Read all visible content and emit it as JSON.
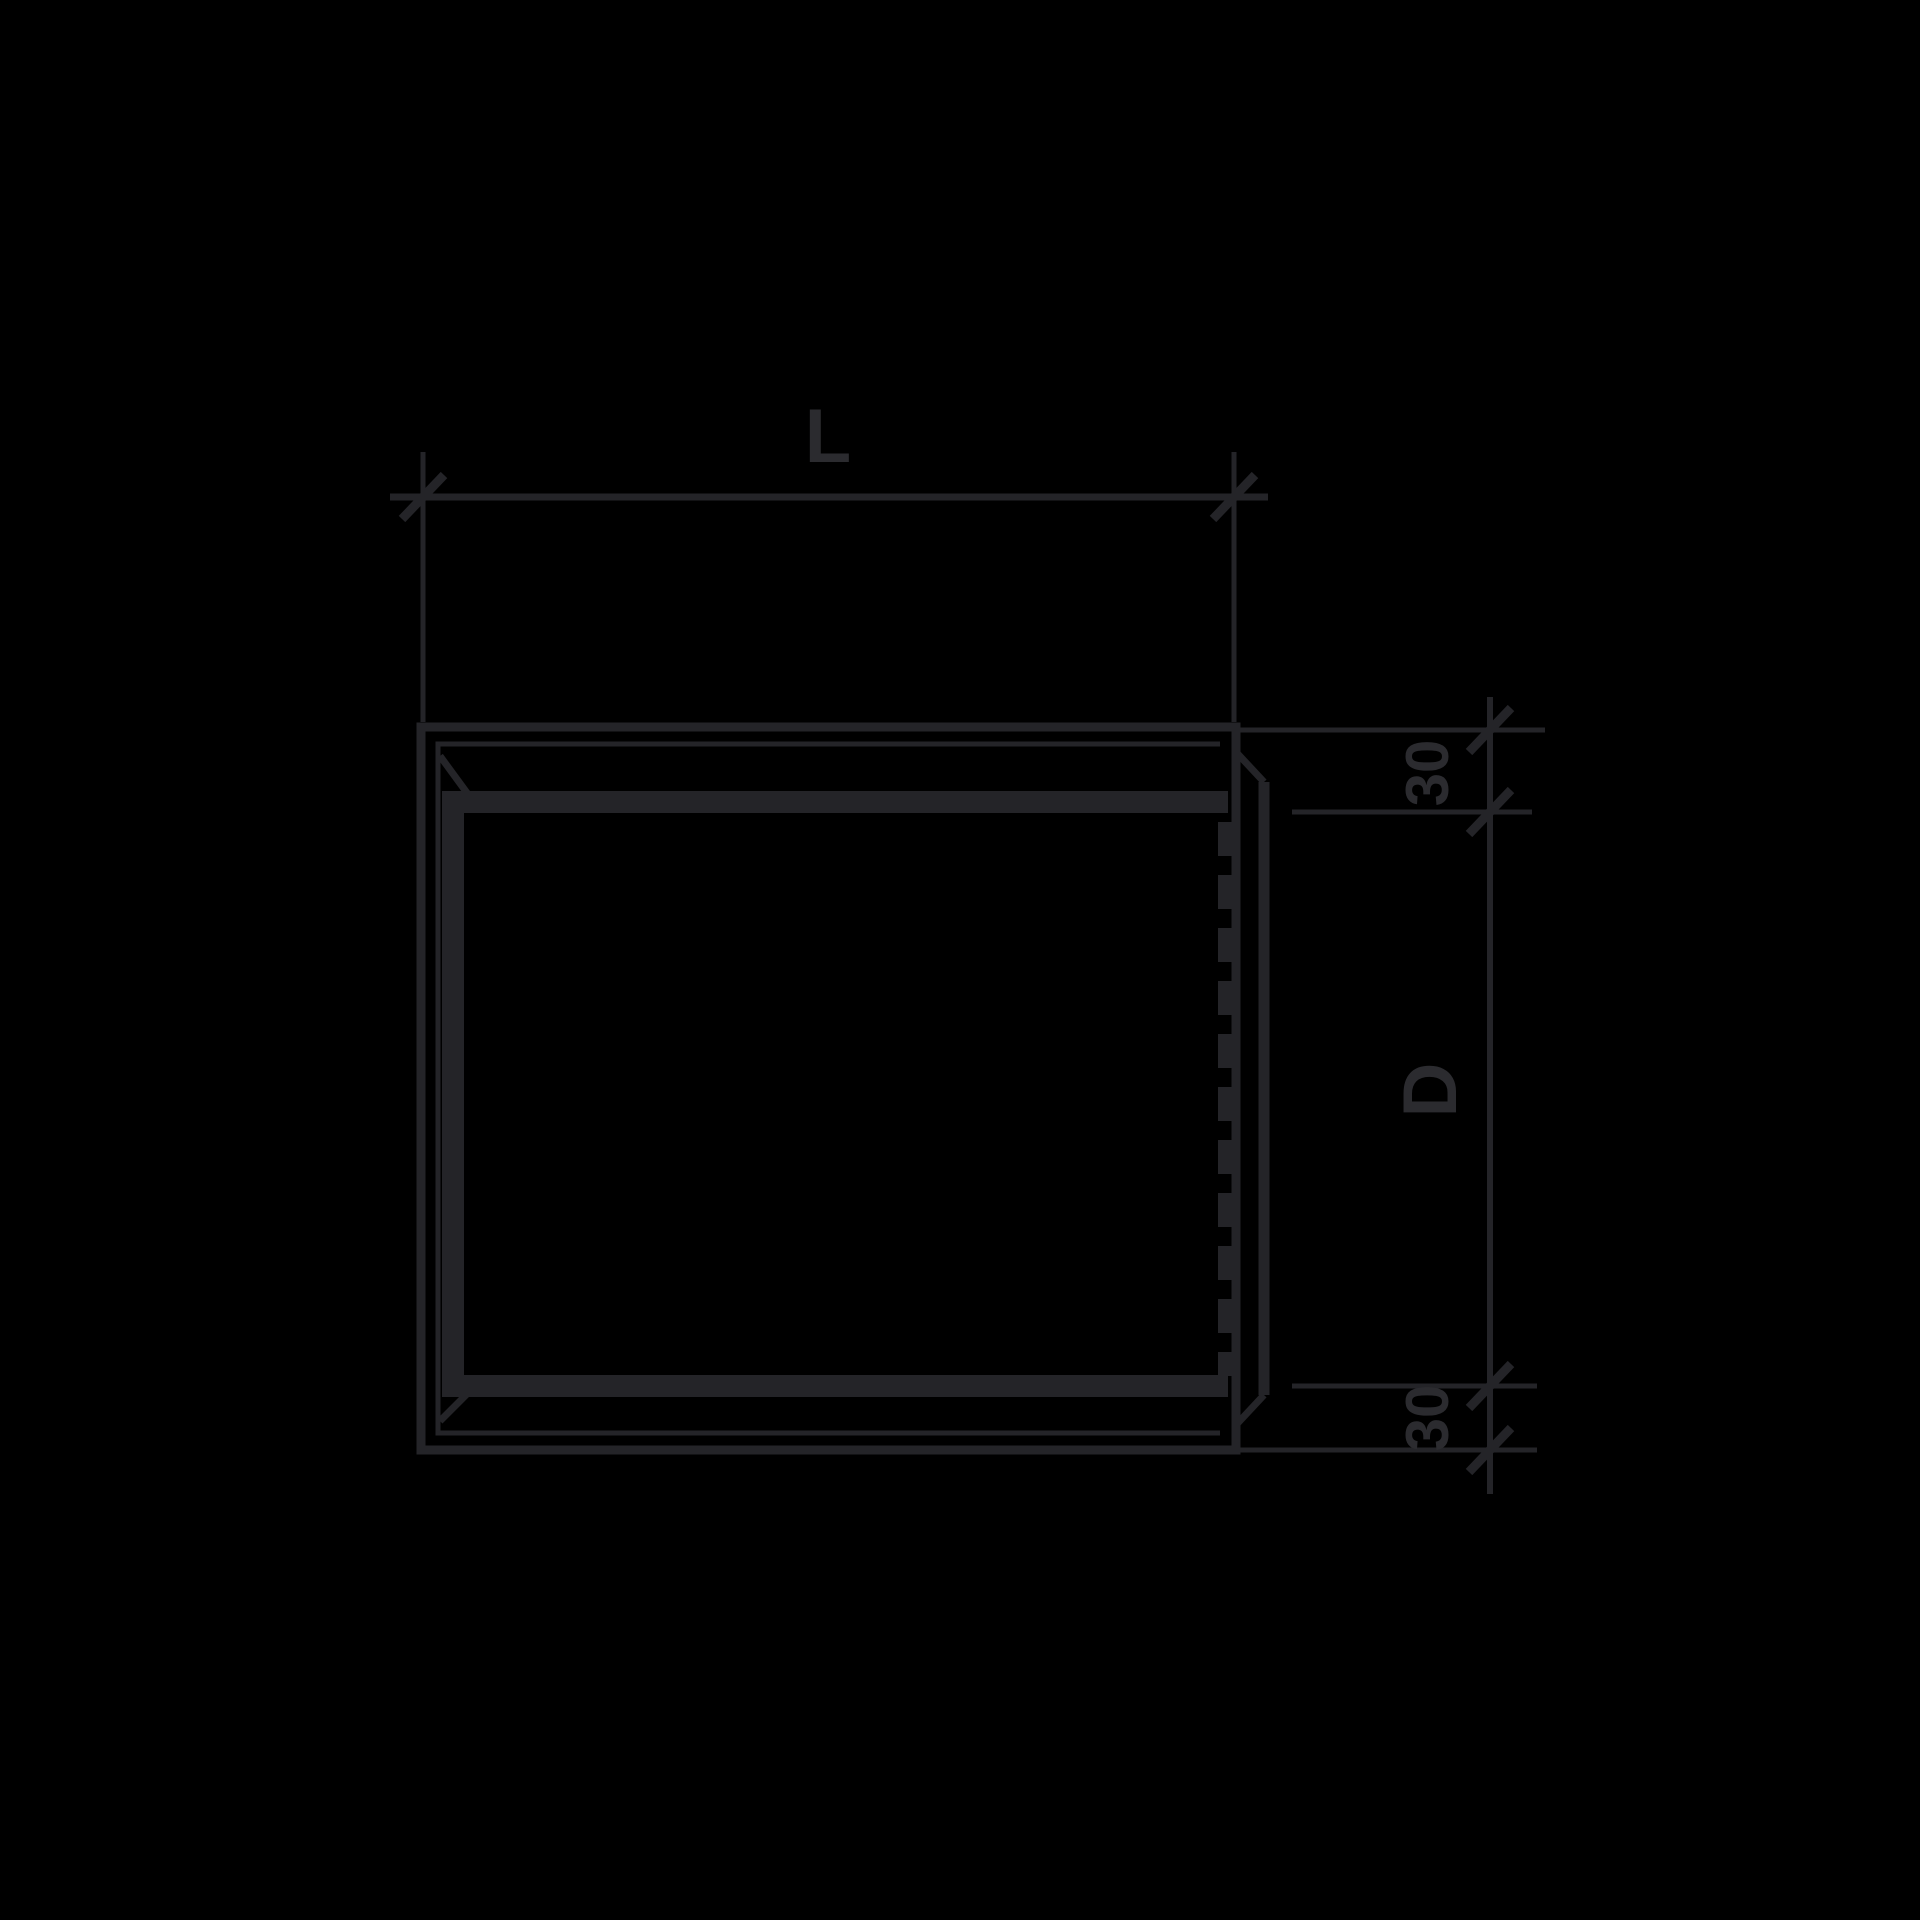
{
  "figure": {
    "kind": "technical-dimension-drawing",
    "description": "Side view of a rectangular duct section with flanged frame, hidden seam line (dashed) and right-hand collar, annotated with length, depth and flange dimensions on a black background"
  },
  "colors": {
    "background": "#000000",
    "line": "#242428",
    "label": "#2b2b2f"
  },
  "dimensions": {
    "length": {
      "label": "L"
    },
    "depth": {
      "label": "D"
    },
    "flange_top": {
      "label": "30"
    },
    "flange_bottom": {
      "label": "30"
    }
  }
}
